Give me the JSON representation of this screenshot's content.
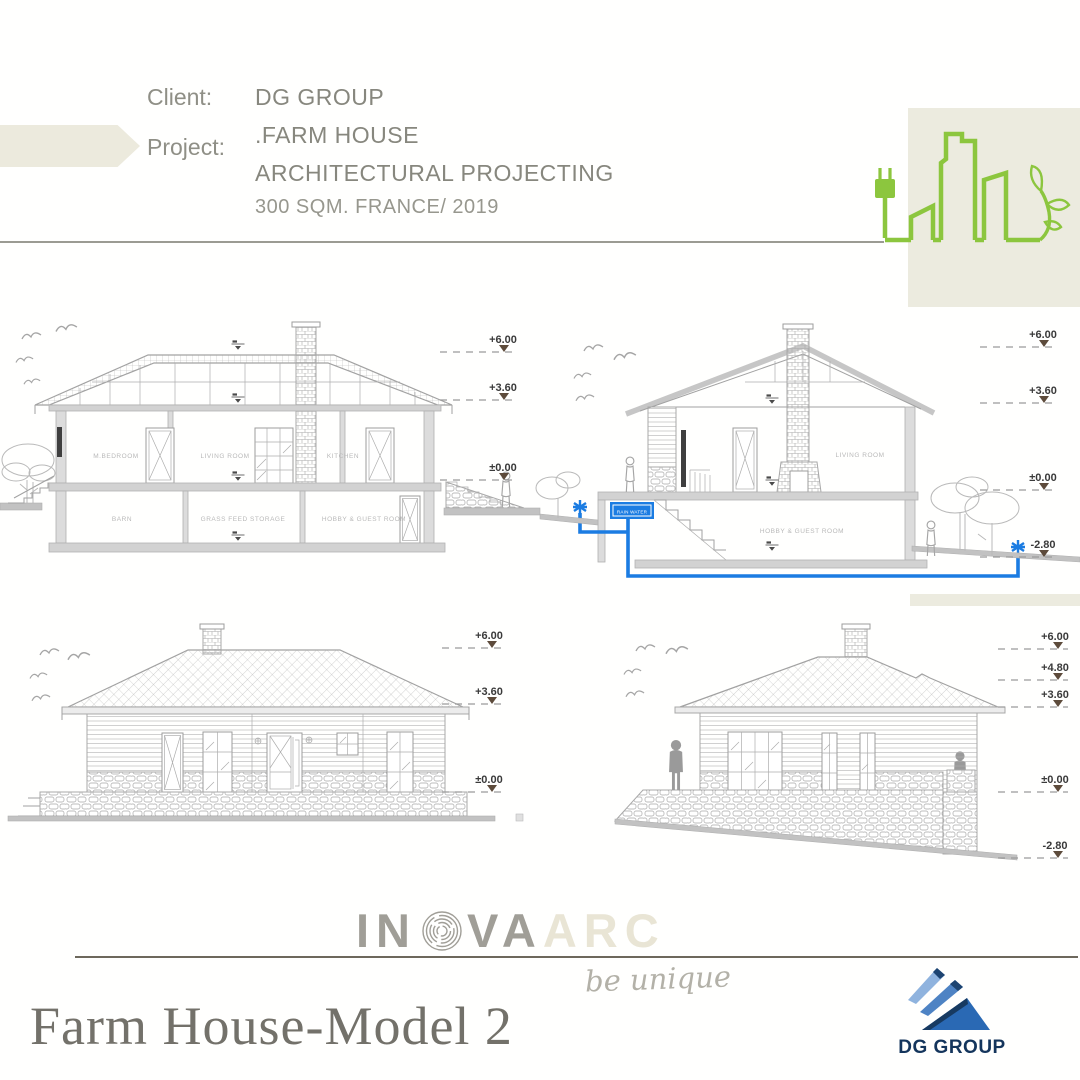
{
  "header": {
    "client_label": "Client:",
    "client_value": "DG GROUP",
    "project_label": "Project:",
    "project_name": ".FARM HOUSE",
    "project_type": "ARCHITECTURAL PROJECTING",
    "project_meta": "300 SQM. FRANCE/ 2019"
  },
  "drawings": {
    "section_a": {
      "rooms_upper": [
        "M.BEDROOM",
        "LIVING ROOM",
        "KITCHEN"
      ],
      "rooms_lower": [
        "BARN",
        "GRASS FEED STORAGE",
        "HOBBY & GUEST ROOM"
      ],
      "levels": [
        "+6.00",
        "+3.60",
        "±0.00"
      ]
    },
    "section_b": {
      "rooms": [
        "LIVING ROOM",
        "HOBBY & GUEST ROOM"
      ],
      "tank_label": "RAIN WATER",
      "levels": [
        "+6.00",
        "+3.60",
        "±0.00",
        "-2.80"
      ]
    },
    "front_elevation": {
      "levels": [
        "+6.00",
        "+3.60",
        "±0.00"
      ]
    },
    "side_elevation": {
      "levels": [
        "+6.00",
        "+4.80",
        "+3.60",
        "±0.00",
        "-2.80"
      ]
    }
  },
  "branding": {
    "logo_in": "IN",
    "logo_va": "VA",
    "logo_arc": "ARC",
    "tagline": "be unique",
    "poster_title": "Farm House-Model 2",
    "dg_group": "DG GROUP"
  },
  "colors": {
    "accent_green": "#8cc63e",
    "accent_blue": "#1b7ce2",
    "beige": "#ecebdf",
    "drawing_gray": "#a2a2a2",
    "marker_brown": "#5d4b3b",
    "dg_navy": "#14355c"
  }
}
